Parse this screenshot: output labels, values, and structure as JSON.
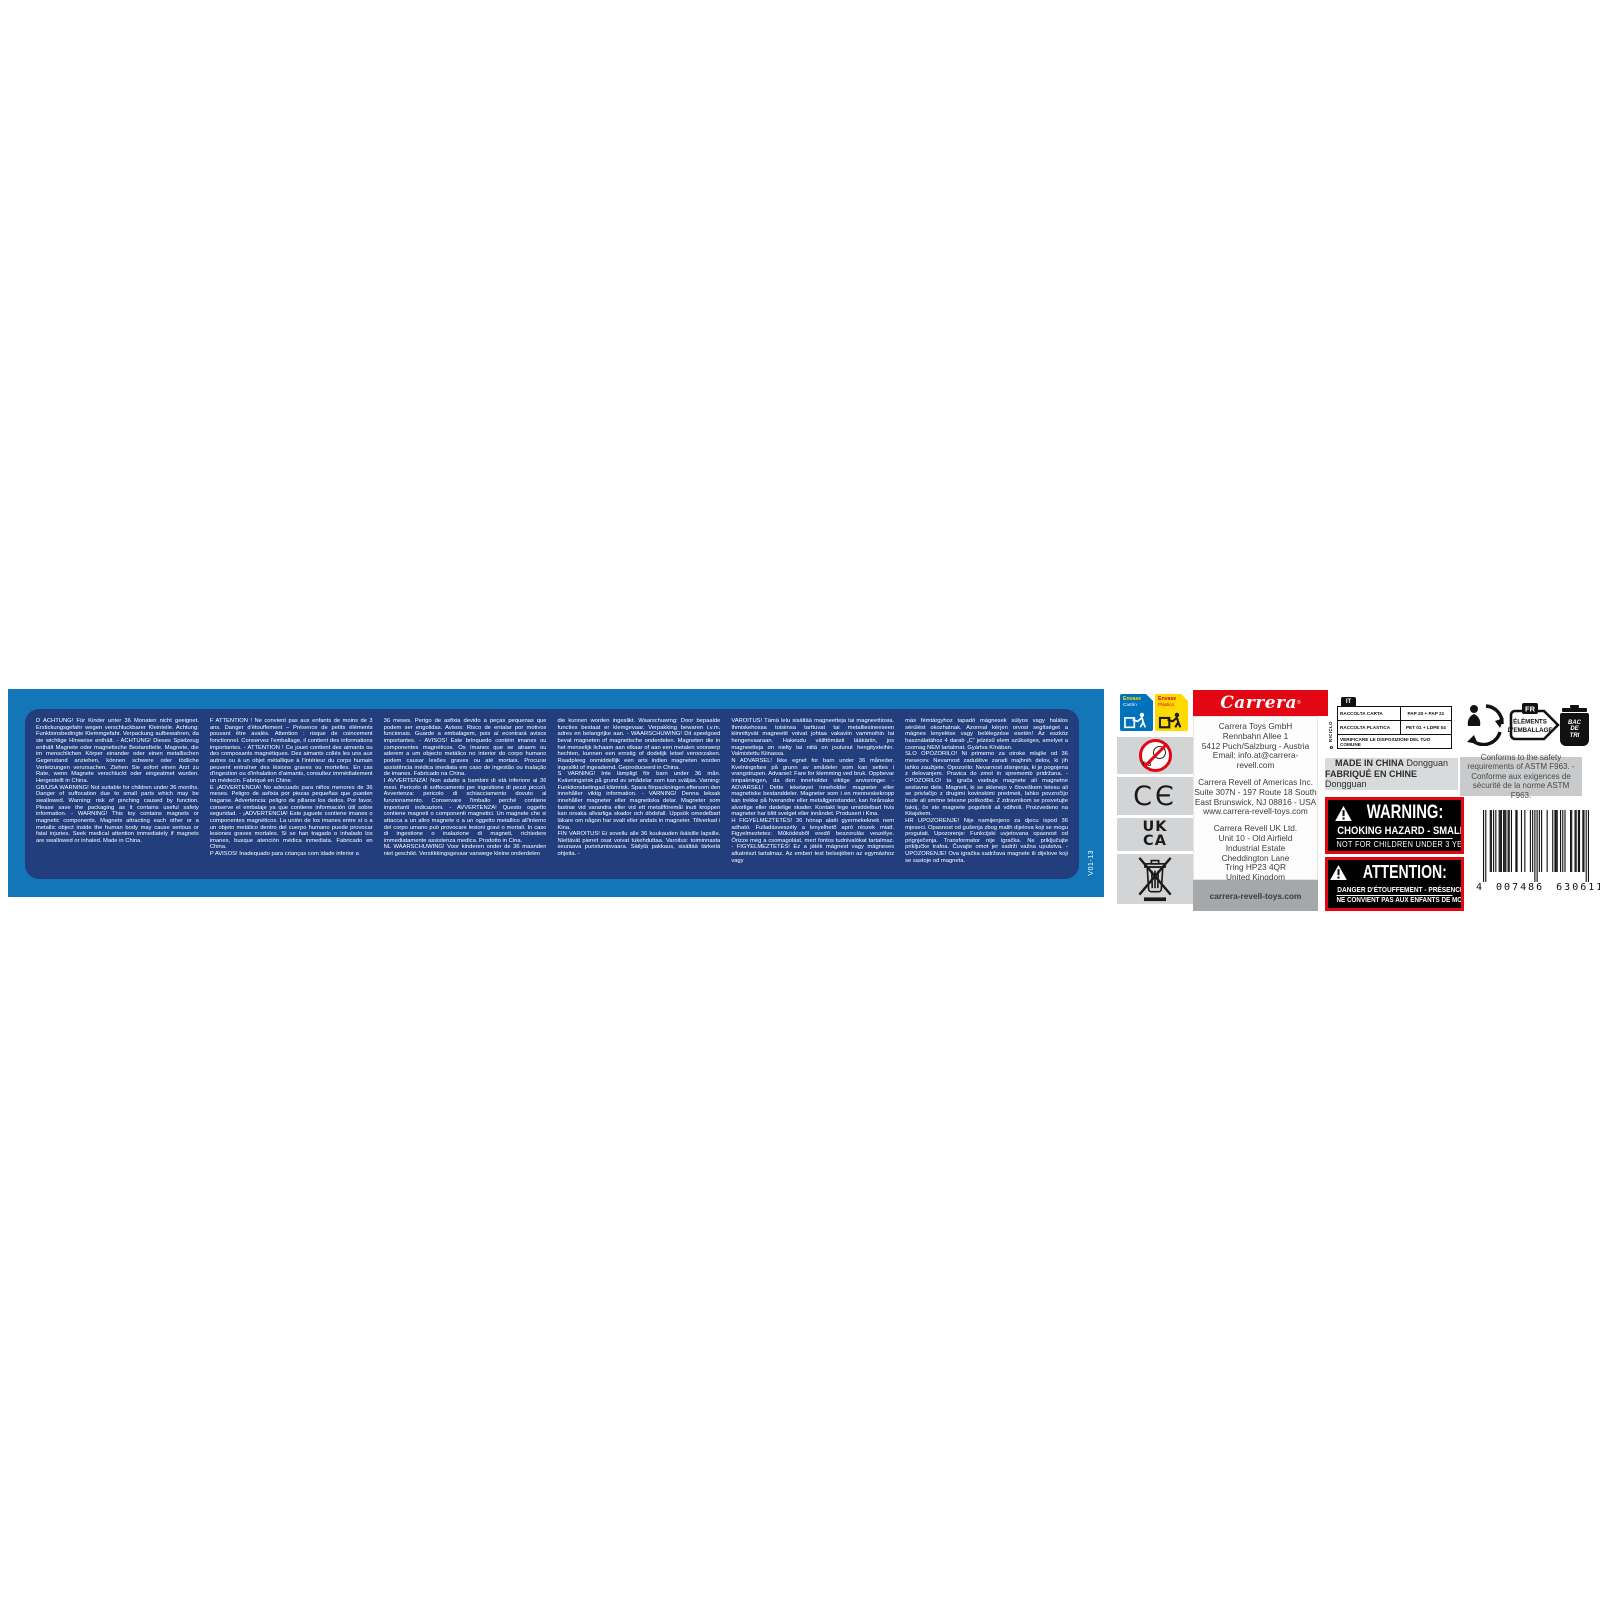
{
  "label": {
    "version_code": "V01-13",
    "warning_panel": {
      "columns": [
        [
          "D   ACHTUNG! Für Kinder unter 36 Monaten nicht geeignet. Erstickungsgefahr wegen verschluckbarer Kleinteile. Achtung: Funktionsbedingte Klemmgefahr. Verpackung aufbewahren, da sie wichtige Hinweise enthält. - ACHTUNG! Dieses Spielzeug enthält Magnete oder magnetische Bestandteile. Magnete, die im menschlichen Körper einander oder einen metallischen Gegenstand anziehen, können schwere oder tödliche Verletzungen verursachen. Ziehen Sie sofort einen Arzt zu Rate, wenn Magnete verschluckt oder eingeatmet wurden. Hergestellt in China.",
          "GB/USA   WARNING! Not suitable for children under 36 months. Danger of suffocation due to small parts which may be swallowed. Warning: risk of pinching caused by function. Please save the packaging as it contains useful safety information. - WARNING! This toy contains magnets or magnetic components. Magnets attracting each other or a metallic object inside the human body may cause serious or fatal injuries. Seek medical attention immediately if magnets are swallowed or inhaled. Made in China."
        ],
        [
          "F   ATTENTION ! Ne convient pas aux enfants de moins de 3 ans. Danger d'étouffement – Présence de petits éléments pouvant être avalés. Attention : risque de coincement fonctionnel. Conservez l'emballage, il contient des informations importantes. - ATTENTION ! Ce jouet contient des aimants ou des composants magnétiques. Des aimants collés les uns aux autres ou à un objet métallique à l'intérieur du corps humain peuvent entraîner des lésions graves ou mortelles. En cas d'ingestion ou d'inhalation d'aimants, consultez immédiatement un médecin. Fabriqué en Chine.",
          "E   ¡ADVERTENCIA! No adecuado para niños menores de 36 meses. Peligro de asfixia por piezas pequeñas que pueden tragarse. Advertencia: peligro de pillarse los dedos. Por favor, conserve el embalaje ya que contiene información útil sobre seguridad. - ¡ADVERTENCIA! Este juguete contiene imanes o componentes magnéticos. La unión de los imanes entre sí o a un objeto metálico dentro del cuerpo humano puede provocar lesiones graves mortales. Si se han tragado o inhalado los imanes, busque atención médica inmediata. Fabricado en China.",
          "P   AVISOS! Inadequado para crianças com idade inferior a"
        ],
        [
          "36 meses. Perigo de asfixia devido a peças pequenas que podem ser engolidas. Avisos: Risco de entalar por motivos funcionais. Guarde a embalagem, pois aí econtrará avisos importantes. - AVISOS! Este brinquedo contém imanes ou componentes magnéticos. Os ímanes que se atraem ou aderem a um objecto metálico no interior do corpo humano podem causar lesões graves ou até mortais. Procurar assistência médica imediata em caso de ingestão ou inalação de imanes. Fabricado na China.",
          "I   AVVERTENZA! Non adatto a bambini di età inferiore ai 36 mesi. Pericolo di soffocamento per ingestione di pezzi piccoli. Avvertenza: pericolo di schiacciamento dovuto al funzionamento. Conservare l'imballo perché contiene importanti indicazioni. - AVVERTENZA! Questo oggetto contiene magneti o componenti magnetici. Un magnete che si attacca a un altro magnete o a un oggetto metallico all'interno del corpo umano può provocare lesioni gravi o mortali. In caso di ingestione o inalazione di magneti, richiedere immediatamente assistenza medica. Prodotto in Cina.",
          "NL   WAARSCHUWING! Voor kinderen onder de 36 maanden niet geschikt. Verstikkingsgevaar vanwege kleine onderdelen"
        ],
        [
          "die kunnen worden ingeslikt. Waarschuwing: Door bepaalde functies bestaat er klemgevaar. Verpakking bewaren i.v.m. adres en belangrijke aan. - WAARSCHUWING! Dit speelgoed bevat magneten of magnetische onderdelen. Magneten die in het menselijk lichaam aan elkaar of aan een metalen voorwerp hechten, kunnen een ernstig of dodelijk letsel veroorzaken. Raadpleeg onmiddellijk een arts indien magneten worden ingeslikt of ingeademd. Geproduceerd in China.",
          "S   VARNING! Inte lämpligt för barn under 36 mån. Kvävningsrisk på grund av smådelar som kan sväljas. Varning: Funktionsbetingad klämrisk. Spara förpackningen eftersom den innehåller viktig information. - VARNING! Denna leksak innehåller magneter eller magnetiska delar. Magneter som fastnar vid varandra eller vid ett metallföremål inuti kroppen kan orsaka allvarliga skador och dödsfall. Uppsök omedelbart läkare om någon har svalt eller andats in magneter. Tillverkad i Kina.",
          "FIN   VAROITUS! Ei sovellu alle 36 kuukauden ikäisille lapsille. Nieltävät pienet osat voivat tukehduttaa. Varoitus: toiminnasta seuraava puristumisvaara. Säilytä pakkaus, sisältää tärkeitä ohjeita. -"
        ],
        [
          "VAROITUS! Tämä lelu sisältää magneetteja tai magneettiosia. Ihmiskehossa toisiinsa tarttuvat tai metalliesineeseen kiinnittyvät magneetit voivat johtaa vakaviin vammoihin tai hengenvaaraan. Hakeudu välittömästi lääkäriin, jos magneetteja on nielty tai niitä on joutunut hengitysteihin. Valmistettu Kiinassa.",
          "N   ADVARSEL! Ikke egnet for barn under 36 måneder. Kvelningsfare på grunn av smådeler som kan settes i vrangstrupen. Advarsel: Fare for klemming ved bruk. Oppbevar innpakningen, da den inneholder viktige anvisninger. - ADVARSEL! Dette leketøyet inneholder magneter eller magnetiske bestanddeler. Magneter som i en menneskekropp kan trekke på hverandre eller metallgjenstander, kan forårsake alvorlige eller dødelige skader. Kontakt lege umiddelbart hvis magneter har blitt svelget eller innåndet. Produsert i Kina.",
          "H   FIGYELMEZTETÉS! 36 hónap alatti gyermekeknek nem adható. Fulladásveszély a lenyelhető apró részek miatt. Figyelmeztetes: Működésből eredő beszorulás veszélye. Őrizze meg a csomagolást, mert fontos tudnivalókat tartalmaz. - FIGYELMEZTETÉS! Ez a játék mágnest vagy mágneses alkatrészt tartalmaz. Az emberi test belsejében az egymáshoz vagy"
        ],
        [
          "más fémtárgyhoz tapadó mágnesek súlyos vagy halálos sérülést okozhatnak. Azonnal kérjen orvosi segítséget a mágnes lenyelése vagy belélegzése esetén! Az eszköz használatához 4 darab „C” jelzésű elem szükséges, amelyet a csomag NEM tartalmat. Gyártva Kínában.",
          "SLO   OPOZORILO! Ni primerno za otroke mlajše od 36 mesecev. Nevarnost zadušitve zaradi majhnih delov, ki jih lahko zaužijete. Opozorilo: Nevarnost stisnjenja, ki je pogojena z delovanjem. Pravica do zmot in sprememb pridržana. - OPOZORILO! ta igrača vsebuje magnete ali magnetne sestavne dele. Magneti, ki se sklenejo v človeškem telesu ali se privlačijo z drugimi kovinskimi predmeti, lahko povzročijo hude ali smrtne telesne poškodbe. Z zdravnikom se posvetujte takoj, če ste magnete pogoltnili ali vdihnili. Proizvedeno na Kitajskem.",
          "HR   UPOZORENJE! Nije namijenjeno za djecu ispod 36 mjeseci. Opasnost od gušenja zbog malih dijelova koji se mogu progutati. Upozorenje: Funkcijski uvjetovana opasnost od prignječenja. Transformator nije igračka. Ne priključujte priključke trafoa. Čuvajte omot jer sadrži važna uputstva. - UPOZORENJE! Ova igračka sadržava magnete ili dijelove koji se sastoje od magneta."
        ]
      ]
    },
    "symbols": {
      "envase_carton": {
        "line1": "Envase",
        "line2": "Cartón"
      },
      "envase_plastico": {
        "line1": "Envase",
        "line2": "Plástico"
      },
      "age_restriction": "0-3",
      "ce_mark": "CЄ",
      "ukca_line1": "UK",
      "ukca_line2": "CA"
    },
    "brand": {
      "logo_text": "Carrera",
      "registered": "®",
      "addresses": [
        {
          "lines": [
            "Carrera Toys GmbH",
            "Rennbahn Allee 1",
            "5412 Puch/Salzburg - Austria",
            "Email: info.at@carrera-revell.com"
          ]
        },
        {
          "lines": [
            "Carrera Revell of Americas Inc.",
            "Suite 307N - 197 Route 18 South",
            "East Brunswick, NJ 08816 - USA",
            "www.carrera-revell-toys.com"
          ]
        },
        {
          "lines": [
            "Carrera Revell UK Ltd.",
            "Unit 10 - Old Airfield",
            "Industrial Estate",
            "Cheddington Lane",
            "Tring HP23 4QR",
            "United Kingdom"
          ]
        }
      ],
      "website": "carrera-revell-toys.com"
    },
    "it_recycling": {
      "country_code": "IT",
      "side_label": "RICICLO",
      "rows": [
        [
          "RACCOLTA CARTA",
          "PAP 20 + PAP 21"
        ],
        [
          "RACCOLTA PLASTICA",
          "PET 01 + LDPE 04"
        ]
      ],
      "footer": "VERIFICARE LE DISPOSIZIONI DEL TUO COMUNE"
    },
    "origin": {
      "line1_bold": "MADE IN CHINA",
      "line1_rest": " Dongguan",
      "line2_bold": "FABRIQUÉ EN CHINE",
      "line2_rest": " Dongguan"
    },
    "choking_warning_en": {
      "title": "WARNING:",
      "line1": "CHOKING HAZARD - SMALL PARTS",
      "line2": "NOT FOR CHILDREN UNDER 3 YEARS."
    },
    "choking_warning_fr": {
      "title": "ATTENTION:",
      "line1": "DANGER D'ÉTOUFFEMENT - PRÉSENCE DE PETITES PIÈCES",
      "line2": "NE CONVIENT PAS AUX ENFANTS DE MOINS DE 3 ANS."
    },
    "triman": {
      "country_code": "FR",
      "label_line1": "ÉLÉMENTS",
      "label_line2": "D'EMBALLAGE",
      "bin_line1": "BAC",
      "bin_line2": "DE",
      "bin_line3": "TRI"
    },
    "astm_note": "Conforms to the safety requirements of ASTM F963. - Conforme aux exigences de sécurité de la norme ASTM F963.",
    "barcode": {
      "digit_group1": "4",
      "digit_group2": "007486",
      "digit_group3": "630611",
      "pattern": "10100011010100111011101101000110001001000010101010101000010000101110010101000011001101100110101"
    }
  },
  "colors": {
    "strip_blue": "#1376b9",
    "panel_navy": "#223e7d",
    "carrera_red": "#e30613",
    "envase_blue": "#0072bc",
    "envase_yellow": "#ffd900",
    "symbol_gray": "#d3d4d6",
    "origin_gray": "#d9dadb",
    "astm_gray": "#c9cacb",
    "website_bar_gray": "#a6a7a9"
  }
}
